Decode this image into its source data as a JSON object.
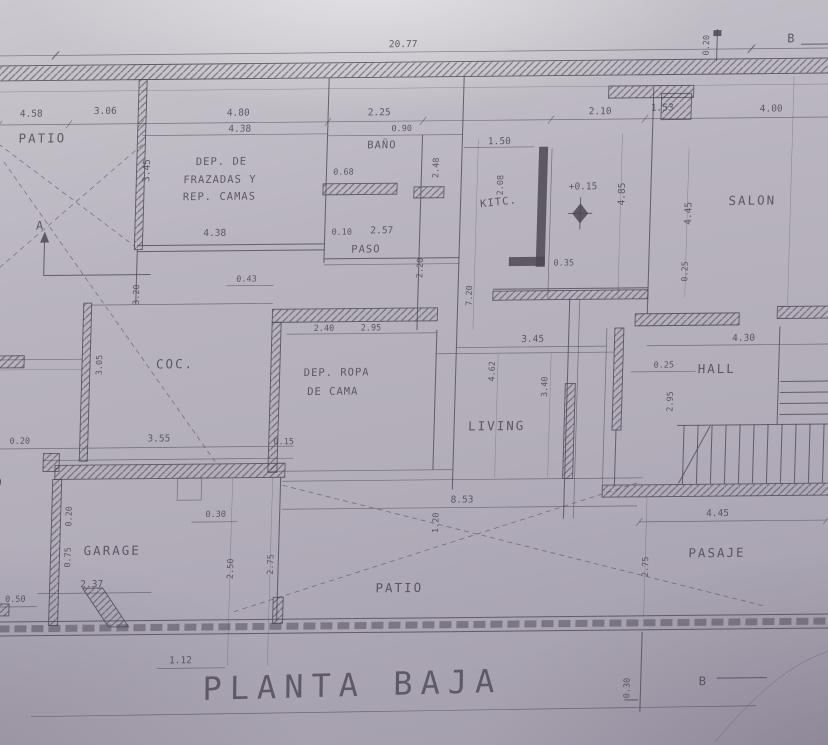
{
  "title": {
    "text": "PLANTA BAJA"
  },
  "colors": {
    "ink": "#4e4855",
    "paper": "#b9b4be",
    "paper_light": "#d2cfd6",
    "paper_dark": "#a29cab"
  },
  "rooms": {
    "patio_top": "PATIO",
    "dep_frazadas": [
      "DEP. DE",
      "FRAZADAS Y",
      "REP. CAMAS"
    ],
    "bano": "BAÑO",
    "paso": "PASO",
    "kitc": "KITC.",
    "salon": "SALON",
    "coc": "COC.",
    "dep_ropa": [
      "DEP. ROPA",
      "DE CAMA"
    ],
    "living": "LIVING",
    "hall": "HALL",
    "garage": "GARAGE",
    "patio_bottom": "PATIO",
    "pasaje": "PASAJE",
    "patio_left_partial": "TIO"
  },
  "markers": {
    "section_a": "A",
    "section_b_top": "B",
    "section_b_bottom": "B",
    "level": "+0.15"
  },
  "dims": {
    "overall": "20.77",
    "top_left_a": "4.58",
    "top_left_b": "3.06",
    "frazadas_w": "4.80",
    "frazadas_w2": "4.38",
    "bano_w": "2.25",
    "bano_small": "0.90",
    "bano_d": "0.68",
    "bano_h": "2.48",
    "kitc_w": "1.50",
    "kitc_h": "2.08",
    "salon_a": "2.10",
    "salon_b": "1.53",
    "salon_w": "4.00",
    "salon_h1": "4.85",
    "salon_h2": "4.45",
    "salon_s": "0.25",
    "salon_t": "0.35",
    "paso_w": "4.38",
    "paso_a": "0.10",
    "paso_b": "2.57",
    "paso_h": "2.20",
    "col_h": "7.20",
    "coc_s": "0.43",
    "coc_v": "3.20",
    "coc_h": "3.05",
    "patio_h": "3.45",
    "ropa_a": "2.40",
    "ropa_b": "2.95",
    "living_w": "3.45",
    "living_h": "4.62",
    "living_h2": "3.40",
    "hall_w": "4.30",
    "hall_s": "0.25",
    "hall_h": "2.95",
    "mid_a": "0.20",
    "mid_b": "3.55",
    "mid_c": "0.15",
    "patio2_w": "8.53",
    "patio2_s": "1.20",
    "patio2_h1": "2.50",
    "patio2_h2": "2.75",
    "garage_door": "0.30",
    "garage_a": "0.20",
    "garage_b": "0.75",
    "garage_w": "2.37",
    "left_s": "0.50",
    "garage_bw": "1.12",
    "pasaje_w": "4.45",
    "pasaje_h": "2.75",
    "b_top": "0.20",
    "b_bottom": "0.30"
  }
}
